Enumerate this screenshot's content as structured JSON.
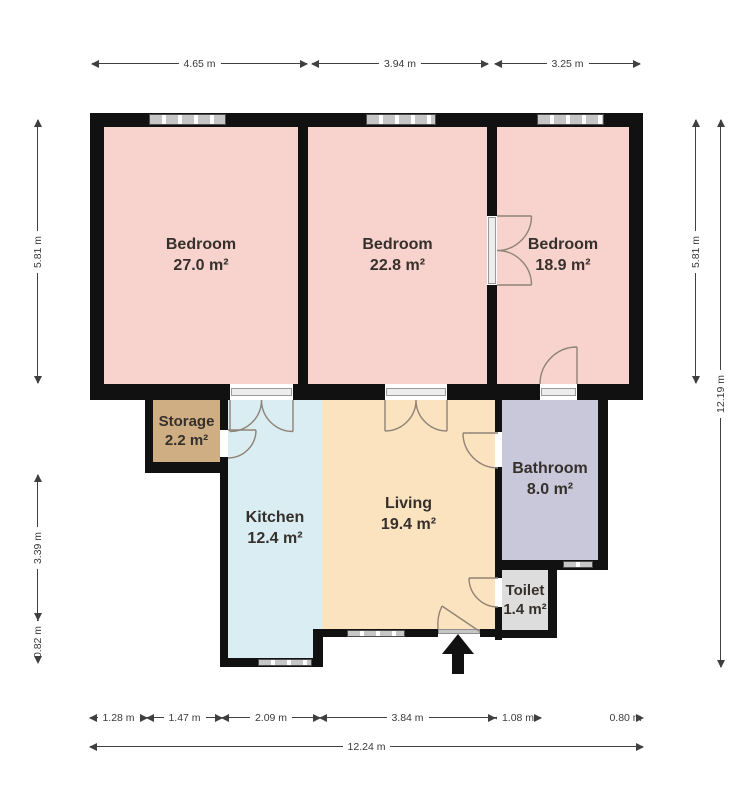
{
  "plan_title": "Apartment floor plan",
  "rooms": [
    {
      "id": "bedroom-1",
      "name": "Bedroom",
      "area": "27.0 m²",
      "color": "#f8d2cc"
    },
    {
      "id": "bedroom-2",
      "name": "Bedroom",
      "area": "22.8 m²",
      "color": "#f8d2cc"
    },
    {
      "id": "bedroom-3",
      "name": "Bedroom",
      "area": "18.9 m²",
      "color": "#f8d2cc"
    },
    {
      "id": "storage",
      "name": "Storage",
      "area": "2.2 m²",
      "color": "#cfae83"
    },
    {
      "id": "kitchen",
      "name": "Kitchen",
      "area": "12.4 m²",
      "color": "#d9edf2"
    },
    {
      "id": "living",
      "name": "Living",
      "area": "19.4 m²",
      "color": "#fbe3c0"
    },
    {
      "id": "bathroom",
      "name": "Bathroom",
      "area": "8.0 m²",
      "color": "#c8c8da"
    },
    {
      "id": "toilet",
      "name": "Toilet",
      "area": "1.4 m²",
      "color": "#dddddd"
    }
  ],
  "dimensions": {
    "top": [
      "4.65 m",
      "3.94 m",
      "3.25 m"
    ],
    "left": [
      "5.81 m",
      "3.39 m",
      "0.82 m"
    ],
    "right_inner": "5.81 m",
    "right_outer": "12.19 m",
    "bottom": [
      "1.28 m",
      "1.47 m",
      "2.09 m",
      "3.84 m",
      "1.08 m",
      "0.80 m"
    ],
    "bottom_total": "12.24 m"
  },
  "colors": {
    "wall": "#111111",
    "window": "#c6c6c6",
    "door_arc": "#8f8377",
    "dimension_line": "#3f3f3f",
    "entrance_arrow": "#111111",
    "background": "#ffffff"
  },
  "entrance": {
    "symbol": "arrow-up"
  }
}
